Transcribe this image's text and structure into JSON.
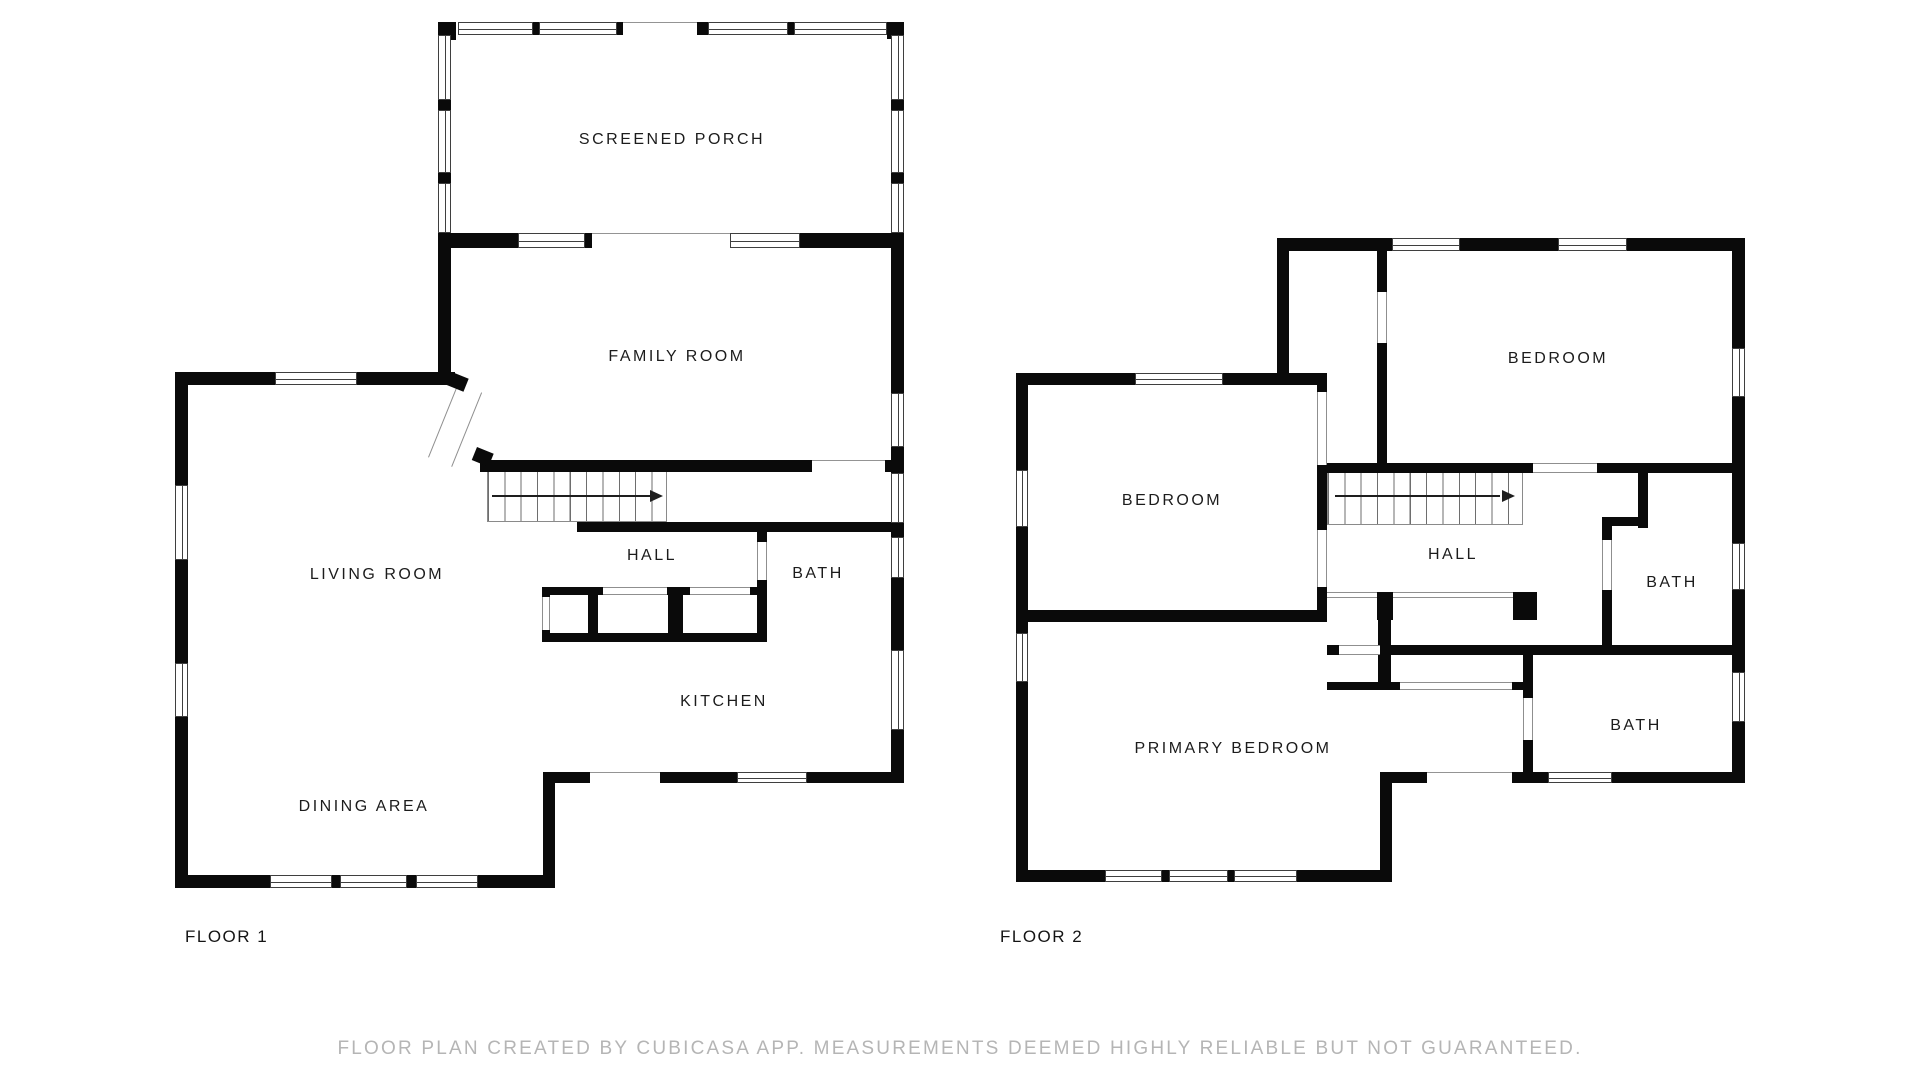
{
  "title": "Floor plan",
  "creator_note": "FLOOR PLAN CREATED BY CUBICASA APP. MEASUREMENTS DEEMED HIGHLY RELIABLE BUT NOT GUARANTEED.",
  "footer": {
    "text": "FLOOR PLAN CREATED BY CUBICASA APP. MEASUREMENTS DEEMED HIGHLY RELIABLE BUT NOT GUARANTEED."
  },
  "floor1": {
    "name": "FLOOR 1",
    "rooms": [
      {
        "id": "screened-porch",
        "label": "SCREENED PORCH"
      },
      {
        "id": "family-room",
        "label": "FAMILY ROOM"
      },
      {
        "id": "living-room",
        "label": "LIVING ROOM"
      },
      {
        "id": "hall",
        "label": "HALL"
      },
      {
        "id": "bath",
        "label": "BATH"
      },
      {
        "id": "kitchen",
        "label": "KITCHEN"
      },
      {
        "id": "dining-area",
        "label": "DINING AREA"
      }
    ],
    "stairs": {
      "icon": "stair-direction-arrow",
      "direction": "right",
      "treads": 11
    }
  },
  "floor2": {
    "name": "FLOOR 2",
    "rooms": [
      {
        "id": "bedroom-west",
        "label": "BEDROOM"
      },
      {
        "id": "bedroom-northeast",
        "label": "BEDROOM"
      },
      {
        "id": "hall",
        "label": "HALL"
      },
      {
        "id": "bath-east",
        "label": "BATH"
      },
      {
        "id": "bath-south",
        "label": "BATH"
      },
      {
        "id": "primary-bedroom",
        "label": "PRIMARY BEDROOM"
      }
    ],
    "stairs": {
      "icon": "stair-direction-arrow",
      "direction": "right",
      "treads": 12
    }
  },
  "colors": {
    "wall": "#0a0a0a",
    "window_line": "#3f3f3f",
    "opening_line": "#949494",
    "room_label_text": "#1c1c1c",
    "floor_label_text": "#141414",
    "footer_text": "#b5b5b5",
    "background": "#ffffff"
  }
}
